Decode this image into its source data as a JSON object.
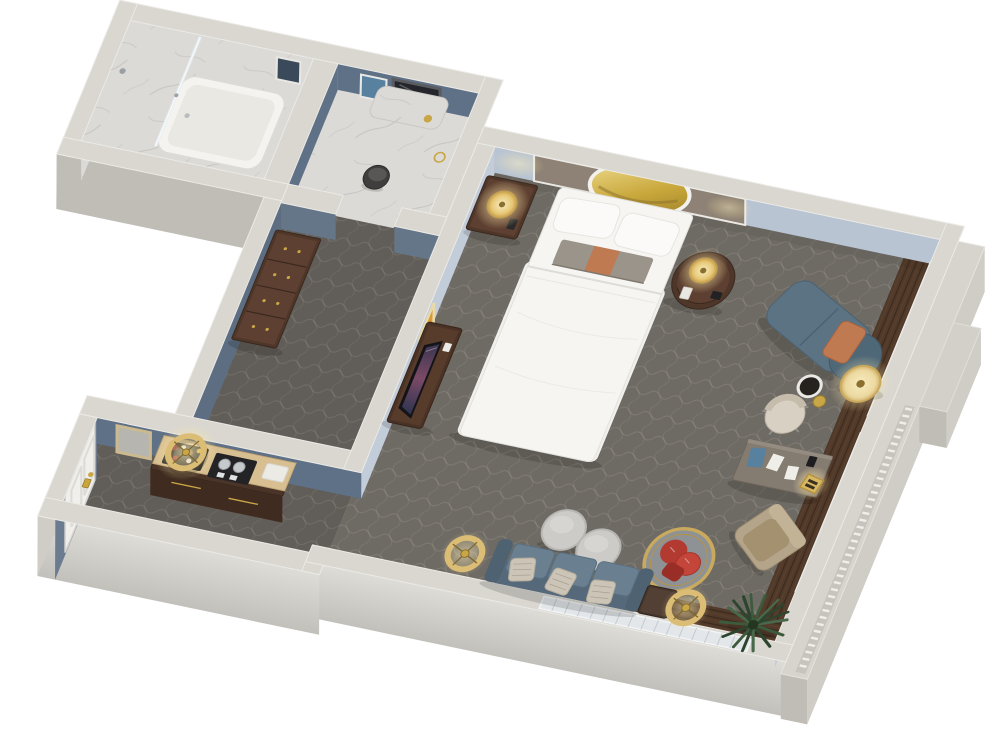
{
  "scene": {
    "type": "3d-floorplan-render",
    "view": "isometric top-down dollhouse view",
    "setting": "hotel guest suite floor plan, white background"
  },
  "colors": {
    "background": "#ffffff",
    "wallTop": "#d9d7d0",
    "wallTopLight": "#eceae6",
    "wallFaceExt": "#cfcdc6",
    "wallFaceExtDark": "#bfbdb6",
    "wallFaceInt": "#b9c4d3",
    "wallFaceIntDark": "#5f7186",
    "carpet": "#6e6a64",
    "carpetHall": "#615d58",
    "marble": "#dcdad7",
    "marbleVein": "#c2c0bd",
    "woodFloor": "#523a2a",
    "woodSlat": "#3b2b1e",
    "walnut": "#4e3629",
    "walnutTop": "#5d4031",
    "bedWhite": "#f6f5f2",
    "headboard": "#8d8275",
    "mirrorGold": "#c9a83c",
    "gold": "#c9a646",
    "goldLight": "#dcbd76",
    "lampGlow": "#ffe9a8",
    "sofaBlue": "#56697a",
    "sofaCushion": "#6a8090",
    "chaiseBlue": "#5b7383",
    "pillowOrange": "#c07a52",
    "pillowBeige": "#ccc5b7",
    "redPillow": "#b23a30",
    "ottoman": "#cccbc8",
    "deskTop": "#847b71",
    "chairCream": "#d7d0c3",
    "armchairTan": "#b4a489",
    "shutter": "#c7d1db",
    "shutterSlat": "#a7b4c2",
    "shutterWhite": "#e3e7ea",
    "plantGreen": "#3c5a3c",
    "plantDark": "#2c452e",
    "doorWhite": "#f0efeb",
    "artOrange": "#d99a33",
    "artBlue": "#58809f",
    "toilet": "#3f3e3d",
    "consoleTopTan": "#d8bf92",
    "trim": "#c6c4bd"
  },
  "rooms": [
    {
      "name": "Bathroom – shower and tub",
      "floor": "white marble",
      "items": [
        "marble shower walls",
        "glass partition",
        "bathtub",
        "shower door",
        "framed artwork"
      ]
    },
    {
      "name": "Water closet",
      "floor": "white marble",
      "items": [
        "vanity mirror",
        "marble counter",
        "toilet",
        "framed artwork",
        "gold towel ring"
      ]
    },
    {
      "name": "Dressing hall",
      "floor": "carpet",
      "items": [
        "walnut dresser",
        "marble door threshold"
      ]
    },
    {
      "name": "Entry corridor",
      "floor": "carpet",
      "items": [
        "entry door with brass lock",
        "minibar console",
        "liquor tray",
        "coffee machine tray",
        "folded towels",
        "gold ring pendant light",
        "framed artwork"
      ]
    },
    {
      "name": "Bedroom and sitting area",
      "floor": "carpet with diamond pattern",
      "items": [
        "king bed with white duvet",
        "upholstered headboard accent wall",
        "gold oval mirror",
        "left nightstand with lamp",
        "round right nightstand with lamp",
        "media console with flat-screen TV",
        "framed orange artwork",
        "chaise lounge with orange pillow",
        "cream drum floor lamp",
        "round side table",
        "writing desk with papers and blue folder",
        "gold desk lamp",
        "cream desk chair",
        "tan lounge armchair",
        "gold basket chair with red pillows",
        "two round gray ottomans",
        "blue three-seat sofa with patterned pillows",
        "espresso side table",
        "two gold ring floor lamps",
        "potted palm",
        "wood window bays",
        "windows with blue-gray shutters",
        "exterior terrace ledge with railing trim"
      ]
    }
  ]
}
